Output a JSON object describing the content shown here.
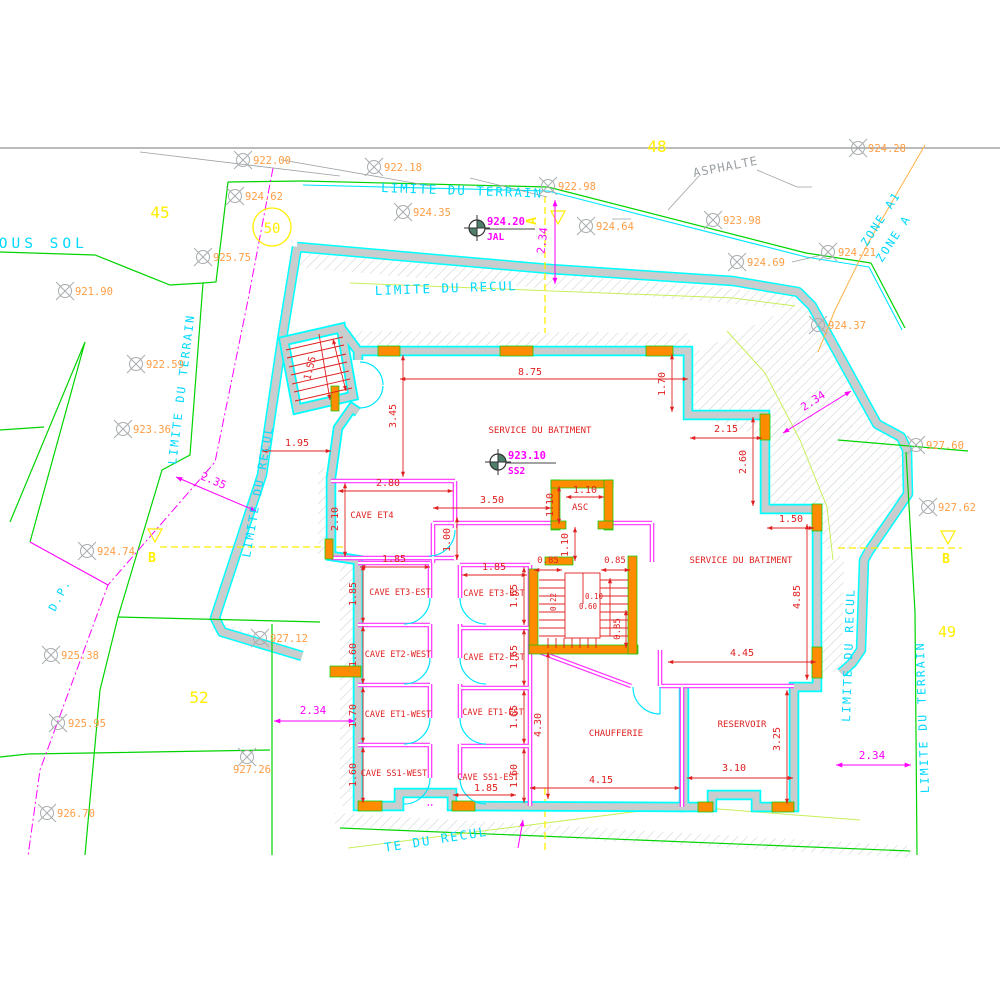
{
  "colors": {
    "cyan": "#00d8ff",
    "green": "#00d400",
    "magenta": "#ff00ff",
    "red": "#e02020",
    "orange_text": "#ff9d45",
    "orange_fill": "#ff8c00",
    "yellow": "#ffee00",
    "gray": "#9aa0a3"
  },
  "texts": {
    "boundary_labels": [
      {
        "v": "LIMITE DU TERRAIN",
        "x": 381,
        "y": 192,
        "r": 2
      },
      {
        "v": "LIMITE DU RECUL",
        "x": 375,
        "y": 295,
        "r": -2
      },
      {
        "v": "SOUS SOL",
        "x": -14,
        "y": 248,
        "fs": 14.5,
        "ls": 4
      },
      {
        "v": "LIMITE DU TERRAIN",
        "x": 176,
        "y": 465,
        "r": -83,
        "fs": 11.5
      },
      {
        "v": "LIMITE DU RECUL",
        "x": 250,
        "y": 558,
        "r": -80,
        "fs": 11.5
      },
      {
        "v": "ZONE A1",
        "x": 867,
        "y": 247,
        "r": -57,
        "fs": 11.5
      },
      {
        "v": "ZONE A",
        "x": 882,
        "y": 263,
        "r": -57,
        "fs": 11.5
      },
      {
        "v": "D.P.",
        "x": 55,
        "y": 612,
        "r": -62,
        "fs": 11
      },
      {
        "v": "LIMITE DU RECUL",
        "x": 850,
        "y": 722,
        "r": -88,
        "fs": 11.5
      },
      {
        "v": "LIMITE DU TERRAIN",
        "x": 929,
        "y": 793,
        "r": -92,
        "fs": 11.5
      },
      {
        "v": "TE DU RECUL",
        "x": 385,
        "y": 852,
        "r": -9
      },
      {
        "v": "ASPHALTE",
        "x": 694,
        "y": 177,
        "r": -11,
        "c": "gray",
        "fs": 12,
        "ls": 1
      }
    ],
    "parcel_numbers": [
      {
        "v": "45",
        "x": 160,
        "y": 218
      },
      {
        "v": "50",
        "x": 272,
        "y": 233,
        "fs": 14
      },
      {
        "v": "48",
        "x": 657,
        "y": 152
      },
      {
        "v": "49",
        "x": 947,
        "y": 637,
        "fs": 15
      },
      {
        "v": "52",
        "x": 199,
        "y": 703
      }
    ],
    "rooms": [
      {
        "v": "SERVICE DU BATIMENT",
        "x": 540,
        "y": 433
      },
      {
        "v": "SERVICE DU BATIMENT",
        "x": 741,
        "y": 563
      },
      {
        "v": "CAVE ET4",
        "x": 372,
        "y": 518
      },
      {
        "v": "CAVE ET3-EST",
        "x": 400,
        "y": 595,
        "fs": 8.5
      },
      {
        "v": "CAVE ET3-EST",
        "x": 494,
        "y": 596,
        "fs": 8.5
      },
      {
        "v": "CAVE ET2-WEST",
        "x": 398,
        "y": 657,
        "fs": 8.5
      },
      {
        "v": "CAVE ET2-EST",
        "x": 494,
        "y": 660,
        "fs": 8.5
      },
      {
        "v": "CAVE ET1-WEST",
        "x": 398,
        "y": 717,
        "fs": 8.5
      },
      {
        "v": "CAVE ET1-EST",
        "x": 493,
        "y": 715,
        "fs": 8.5
      },
      {
        "v": "CAVE SS1-WEST",
        "x": 394,
        "y": 776,
        "fs": 8.5
      },
      {
        "v": "CAVE SS1-EST",
        "x": 488,
        "y": 780,
        "fs": 8.5
      },
      {
        "v": "CHAUFFERIE",
        "x": 616,
        "y": 736
      },
      {
        "v": "RESERVOIR",
        "x": 742,
        "y": 727
      },
      {
        "v": "ASC",
        "x": 572,
        "y": 510,
        "a": "s"
      }
    ],
    "dims": [
      {
        "v": "8.75",
        "x": 530,
        "y": 375
      },
      {
        "v": "3.45",
        "x": 396,
        "y": 416,
        "r": -90
      },
      {
        "v": "1.70",
        "x": 665,
        "y": 384,
        "r": -90
      },
      {
        "v": "1.55",
        "x": 313,
        "y": 369,
        "r": -76
      },
      {
        "v": "1.95",
        "x": 297,
        "y": 446
      },
      {
        "v": "2.15",
        "x": 726,
        "y": 432
      },
      {
        "v": "2.60",
        "x": 746,
        "y": 462,
        "r": -90
      },
      {
        "v": "1.50",
        "x": 791,
        "y": 522
      },
      {
        "v": "2.80",
        "x": 388,
        "y": 486
      },
      {
        "v": "2.10",
        "x": 338,
        "y": 519,
        "r": -90
      },
      {
        "v": "3.50",
        "x": 492,
        "y": 503
      },
      {
        "v": "1.10",
        "x": 585,
        "y": 493
      },
      {
        "v": "1.10",
        "x": 553,
        "y": 505,
        "r": -90
      },
      {
        "v": "1.00",
        "x": 450,
        "y": 540,
        "r": -90
      },
      {
        "v": "1.10",
        "x": 568,
        "y": 545,
        "r": -90
      },
      {
        "v": "1.85",
        "x": 394,
        "y": 562
      },
      {
        "v": "1.85",
        "x": 356,
        "y": 594,
        "r": -90
      },
      {
        "v": "1.85",
        "x": 494,
        "y": 570
      },
      {
        "v": "1.65",
        "x": 517,
        "y": 596,
        "r": -90
      },
      {
        "v": "0.85",
        "x": 548,
        "y": 563,
        "fs": 9
      },
      {
        "v": "0.85",
        "x": 615,
        "y": 563,
        "fs": 9
      },
      {
        "v": "0.22",
        "x": 556,
        "y": 602,
        "r": -90,
        "fs": 7.5
      },
      {
        "v": "0.10",
        "x": 594,
        "y": 599,
        "fs": 7.5
      },
      {
        "v": "0.60",
        "x": 588,
        "y": 609,
        "fs": 7.5
      },
      {
        "v": "0.85",
        "x": 620,
        "y": 629,
        "r": -90,
        "fs": 9
      },
      {
        "v": "1.60",
        "x": 356,
        "y": 655,
        "r": -90
      },
      {
        "v": "1.65",
        "x": 517,
        "y": 657,
        "r": -90
      },
      {
        "v": "1.70",
        "x": 356,
        "y": 716,
        "r": -90
      },
      {
        "v": "1.65",
        "x": 517,
        "y": 717,
        "r": -90
      },
      {
        "v": "1.60",
        "x": 356,
        "y": 775,
        "r": -90
      },
      {
        "v": "1.60",
        "x": 517,
        "y": 776,
        "r": -90
      },
      {
        "v": "4.30",
        "x": 541,
        "y": 725,
        "r": -90
      },
      {
        "v": "1.85",
        "x": 486,
        "y": 791
      },
      {
        "v": "4.15",
        "x": 601,
        "y": 783
      },
      {
        "v": "4.45",
        "x": 742,
        "y": 656
      },
      {
        "v": "4.85",
        "x": 800,
        "y": 597,
        "r": -90
      },
      {
        "v": "3.10",
        "x": 734,
        "y": 771
      },
      {
        "v": "3.25",
        "x": 780,
        "y": 739,
        "r": -90
      }
    ],
    "site_dims": [
      {
        "v": "2.34",
        "x": 546,
        "y": 241,
        "r": -83
      },
      {
        "v": "2.34",
        "x": 815,
        "y": 404,
        "r": -33
      },
      {
        "v": "2.35",
        "x": 212,
        "y": 484,
        "r": 23
      },
      {
        "v": "2.34",
        "x": 313,
        "y": 714
      },
      {
        "v": "2.34",
        "x": 872,
        "y": 759
      }
    ],
    "section_letters": [
      {
        "v": "A",
        "x": 536,
        "y": 221,
        "r": -90
      },
      {
        "v": "B",
        "x": 152,
        "y": 562
      },
      {
        "v": "B",
        "x": 946,
        "y": 563
      }
    ]
  },
  "elevation_points": [
    {
      "v": "922.00",
      "x": 243,
      "y": 160
    },
    {
      "v": "922.18",
      "x": 374,
      "y": 167
    },
    {
      "v": "924.62",
      "x": 235,
      "y": 196
    },
    {
      "v": "922.98",
      "x": 548,
      "y": 186
    },
    {
      "v": "924.35",
      "x": 403,
      "y": 212
    },
    {
      "v": "924.64",
      "x": 586,
      "y": 226
    },
    {
      "v": "923.98",
      "x": 713,
      "y": 220
    },
    {
      "v": "924.28",
      "x": 858,
      "y": 148
    },
    {
      "v": "925.75",
      "x": 203,
      "y": 257
    },
    {
      "v": "921.90",
      "x": 65,
      "y": 291
    },
    {
      "v": "924.69",
      "x": 737,
      "y": 262
    },
    {
      "v": "924.21",
      "x": 828,
      "y": 252
    },
    {
      "v": "924.37",
      "x": 818,
      "y": 325
    },
    {
      "v": "922.59",
      "x": 136,
      "y": 364
    },
    {
      "v": "923.36",
      "x": 123,
      "y": 429
    },
    {
      "v": "927.60",
      "x": 916,
      "y": 445
    },
    {
      "v": "927.62",
      "x": 928,
      "y": 507
    },
    {
      "v": "924.74",
      "x": 87,
      "y": 551
    },
    {
      "v": "927.12",
      "x": 260,
      "y": 638
    },
    {
      "v": "925.38",
      "x": 51,
      "y": 655
    },
    {
      "v": "925.95",
      "x": 58,
      "y": 723
    },
    {
      "v": "927.26",
      "x": 247,
      "y": 757,
      "lp": "b"
    },
    {
      "v": "926.70",
      "x": 47,
      "y": 813
    }
  ],
  "survey_points": [
    {
      "elev": "924.20",
      "name": "JAL",
      "x": 477,
      "y": 228
    },
    {
      "elev": "923.10",
      "name": "SS2",
      "x": 498,
      "y": 462
    }
  ]
}
